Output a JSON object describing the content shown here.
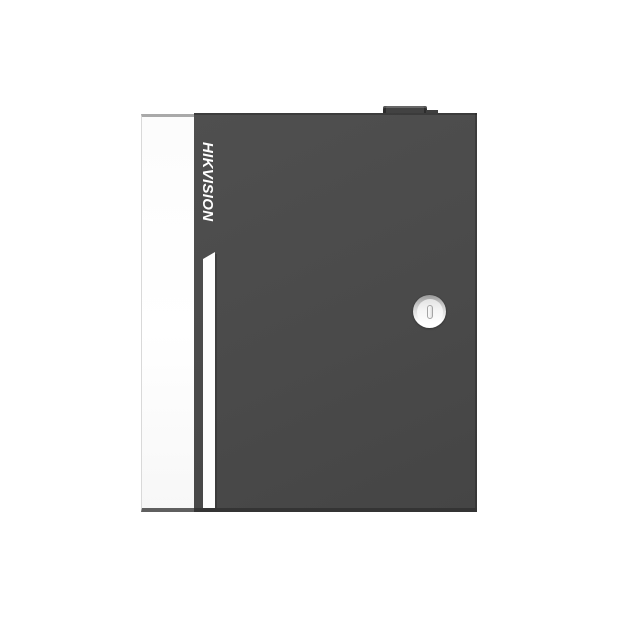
{
  "product": {
    "brand": "HIKVISION",
    "description": "dark gray metal access-control cabinet with white side face, vertical brand logotype, white accent stripe, top conduit knob and round cam lock"
  },
  "colors": {
    "bg": "#ffffff",
    "door-gray": "#4a4a4a",
    "door-bottom": "#343434",
    "panel-white": "#fcfcfc",
    "panel-border-top": "#a9a9a9",
    "panel-border-left": "#d9d9d9",
    "panel-border-bottom": "#5f5f5f",
    "stripe-white": "#fdfdfd",
    "knob-gray": "#424242",
    "knob-cap": "#3e3e3e",
    "logo-white": "#ffffff",
    "lock-ring-top": "#9a9a9a",
    "lock-ring-bottom": "#ffffff",
    "lock-face": "#f5f5f5",
    "slot-border": "#a5a5a5",
    "slot-fill": "#dcdcdc"
  }
}
